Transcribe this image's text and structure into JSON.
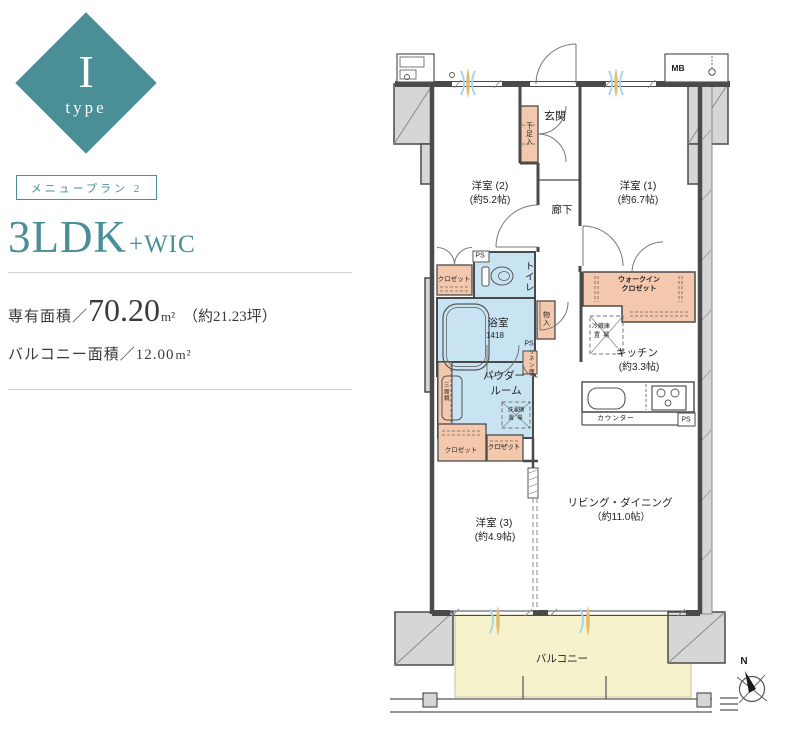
{
  "badge": {
    "letter": "I",
    "type_label": "type"
  },
  "plan_info": {
    "menu_label": "メニュープラン 2",
    "layout_main": "3LDK",
    "layout_suffix": "+WIC",
    "area_label": "専有面積／",
    "area_value": "70.20",
    "area_unit": "m²",
    "area_tsubo": "（約21.23坪）",
    "balcony_label": "バルコニー面積／",
    "balcony_value": "12.00",
    "balcony_unit": "m²"
  },
  "floorplan": {
    "rooms": {
      "genkan": "玄関",
      "hallway": "廊下",
      "bedroom2_name": "洋室 (2)",
      "bedroom2_size": "(約5.2帖)",
      "bedroom1_name": "洋室 (1)",
      "bedroom1_size": "(約6.7帖)",
      "bedroom3_name": "洋室 (3)",
      "bedroom3_size": "(約4.9帖)",
      "living_name": "リビング・ダイニング",
      "living_size": "（約11.0帖）",
      "kitchen_name": "キッチン",
      "kitchen_size": "(約3.3帖)",
      "bath_name": "浴室",
      "bath_code": "1418",
      "powder_line1": "パウダー",
      "powder_line2": "ルーム",
      "toilet": "トイレ",
      "wic_line1": "ウォークイン",
      "wic_line2": "クロゼット",
      "balcony": "バルコニー"
    },
    "features": {
      "mb": "MB",
      "shoe_cabinet": "下足入",
      "closet_bedroom2": "クロゼット",
      "closet_left": "クロゼット",
      "closet_right": "クロゼット",
      "storage": "物入",
      "linen": "リネン庫",
      "fridge_line1": "冷蔵庫",
      "fridge_line2": "置場",
      "washer_line1": "洗濯機",
      "washer_line2": "置場",
      "counter": "カウンター",
      "mirror": "三面鏡",
      "ps_toilet": "PS",
      "ps_linen": "PS",
      "ps_kitchen": "PS",
      "north": "N"
    }
  },
  "colors": {
    "teal": "#4a8e96",
    "salmon": "#f4c8ad",
    "wet_blue": "#c8e3f2",
    "balcony_yellow": "#f6f3cc",
    "wall": "#4a4a4a",
    "accent_tan": "#e5bb72",
    "accent_blue": "#a8d5ea"
  }
}
